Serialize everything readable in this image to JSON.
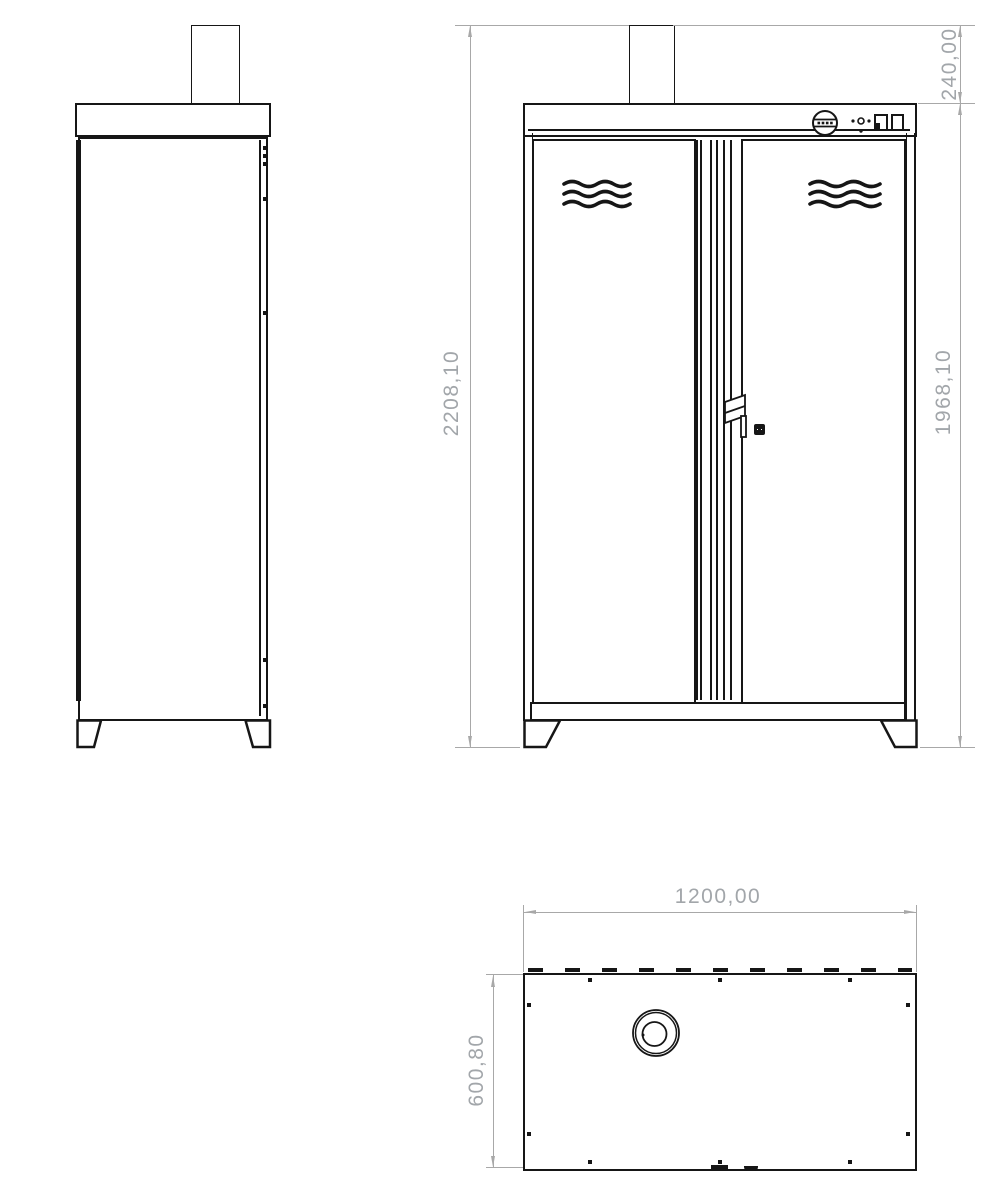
{
  "dimensions": {
    "overall_height": "2208,10",
    "body_height": "1968,10",
    "flue_height": "240,00",
    "overall_width": "1200,00",
    "overall_depth": "600,80"
  },
  "colors": {
    "line": "#161616",
    "dimension_line": "#a8a8a8",
    "dimension_text": "#a2a6aa",
    "background": "#ffffff"
  },
  "icons": {
    "control_knob": "circle-dial-with-slot-dots",
    "power_indicator": "dot-circle-dot",
    "switch_left": "small-rect-toggle",
    "switch_right": "small-rect-toggle",
    "vent": "three-wavy-lines",
    "door_handle": "folded-tab",
    "door_lock": "black-square-keyhole",
    "flue_opening": "concentric-circles"
  }
}
